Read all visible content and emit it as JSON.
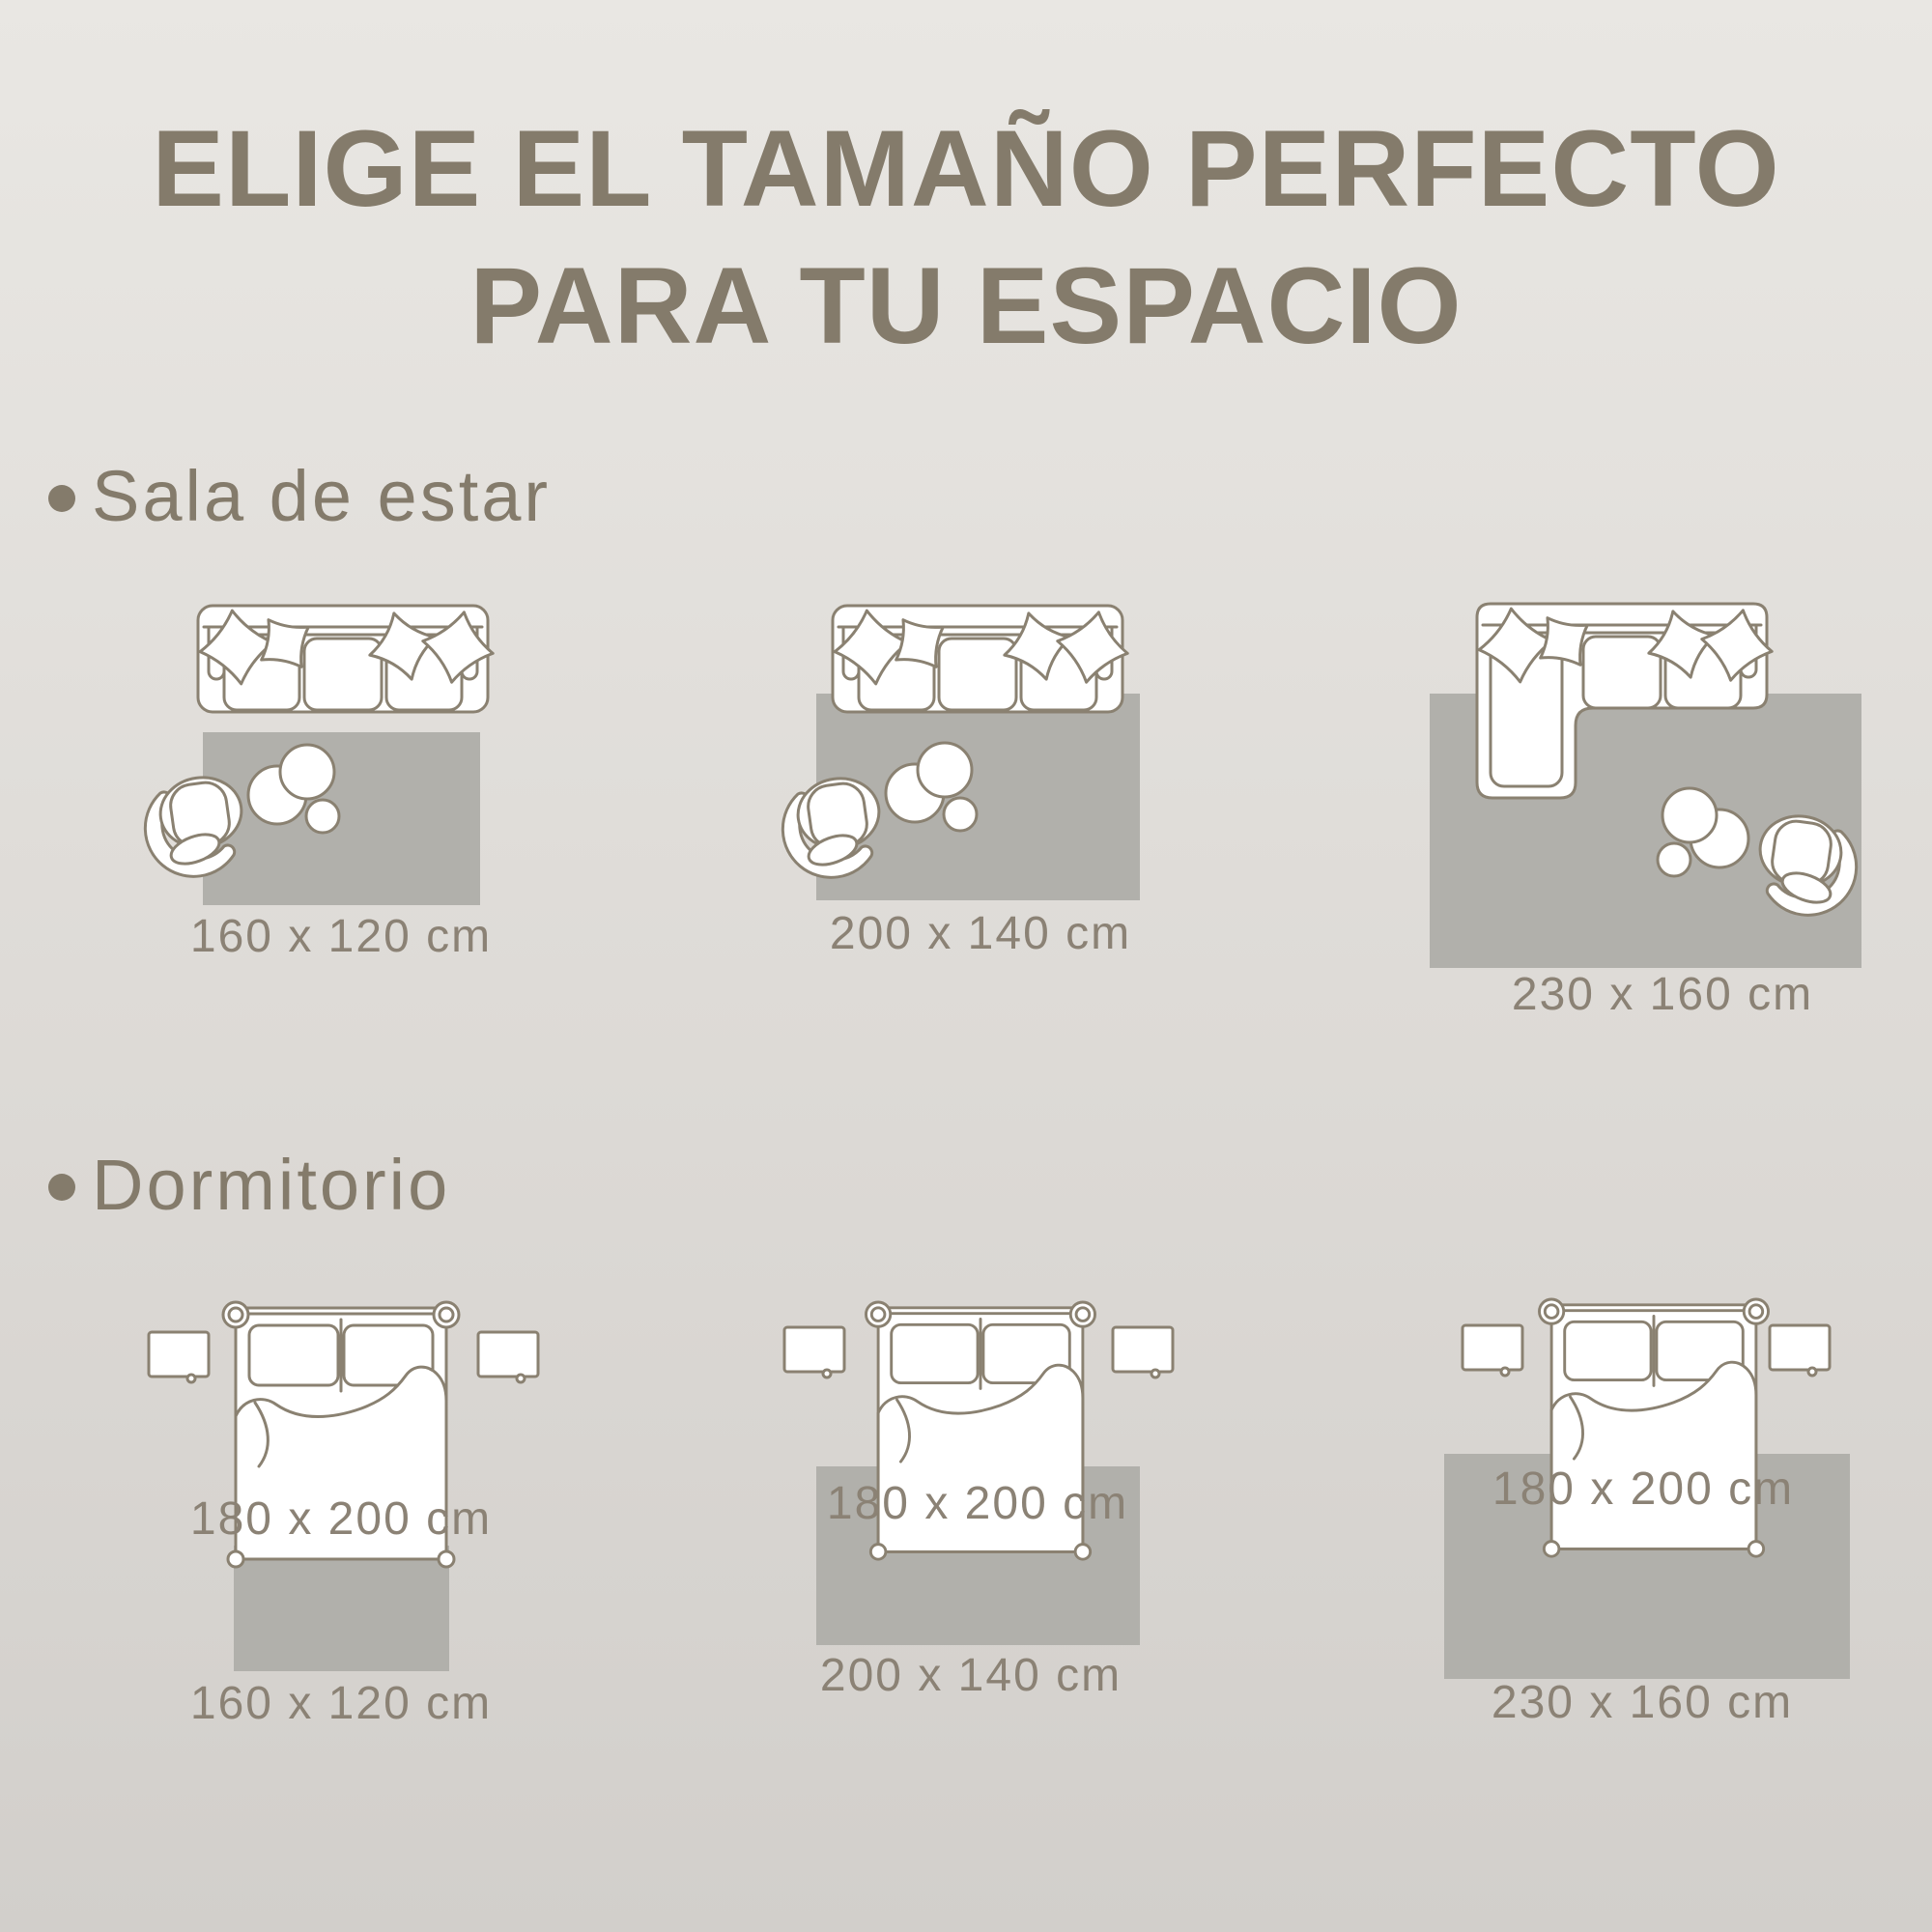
{
  "title": {
    "line1": "ELIGE EL TAMAÑO PERFECTO",
    "line2": "PARA TU ESPACIO"
  },
  "sections": [
    {
      "label": "Sala de estar",
      "items": [
        {
          "rug_size": "160 x 120 cm"
        },
        {
          "rug_size": "200 x 140 cm"
        },
        {
          "rug_size": "230 x 160 cm"
        }
      ]
    },
    {
      "label": "Dormitorio",
      "items": [
        {
          "bed_size": "180 x 200 cm",
          "rug_size": "160 x 120 cm"
        },
        {
          "bed_size": "180 x 200 cm",
          "rug_size": "200 x 140 cm"
        },
        {
          "bed_size": "180 x 200 cm",
          "rug_size": "230 x 160 cm"
        }
      ]
    }
  ],
  "colors": {
    "background_top": "#e9e7e3",
    "background_bottom": "#d2cfcb",
    "title_text": "#847b6b",
    "label_text": "#8b8275",
    "outline": "#8a8171",
    "rug_fill": "#b1b0ab",
    "furniture_fill": "#ffffff"
  }
}
